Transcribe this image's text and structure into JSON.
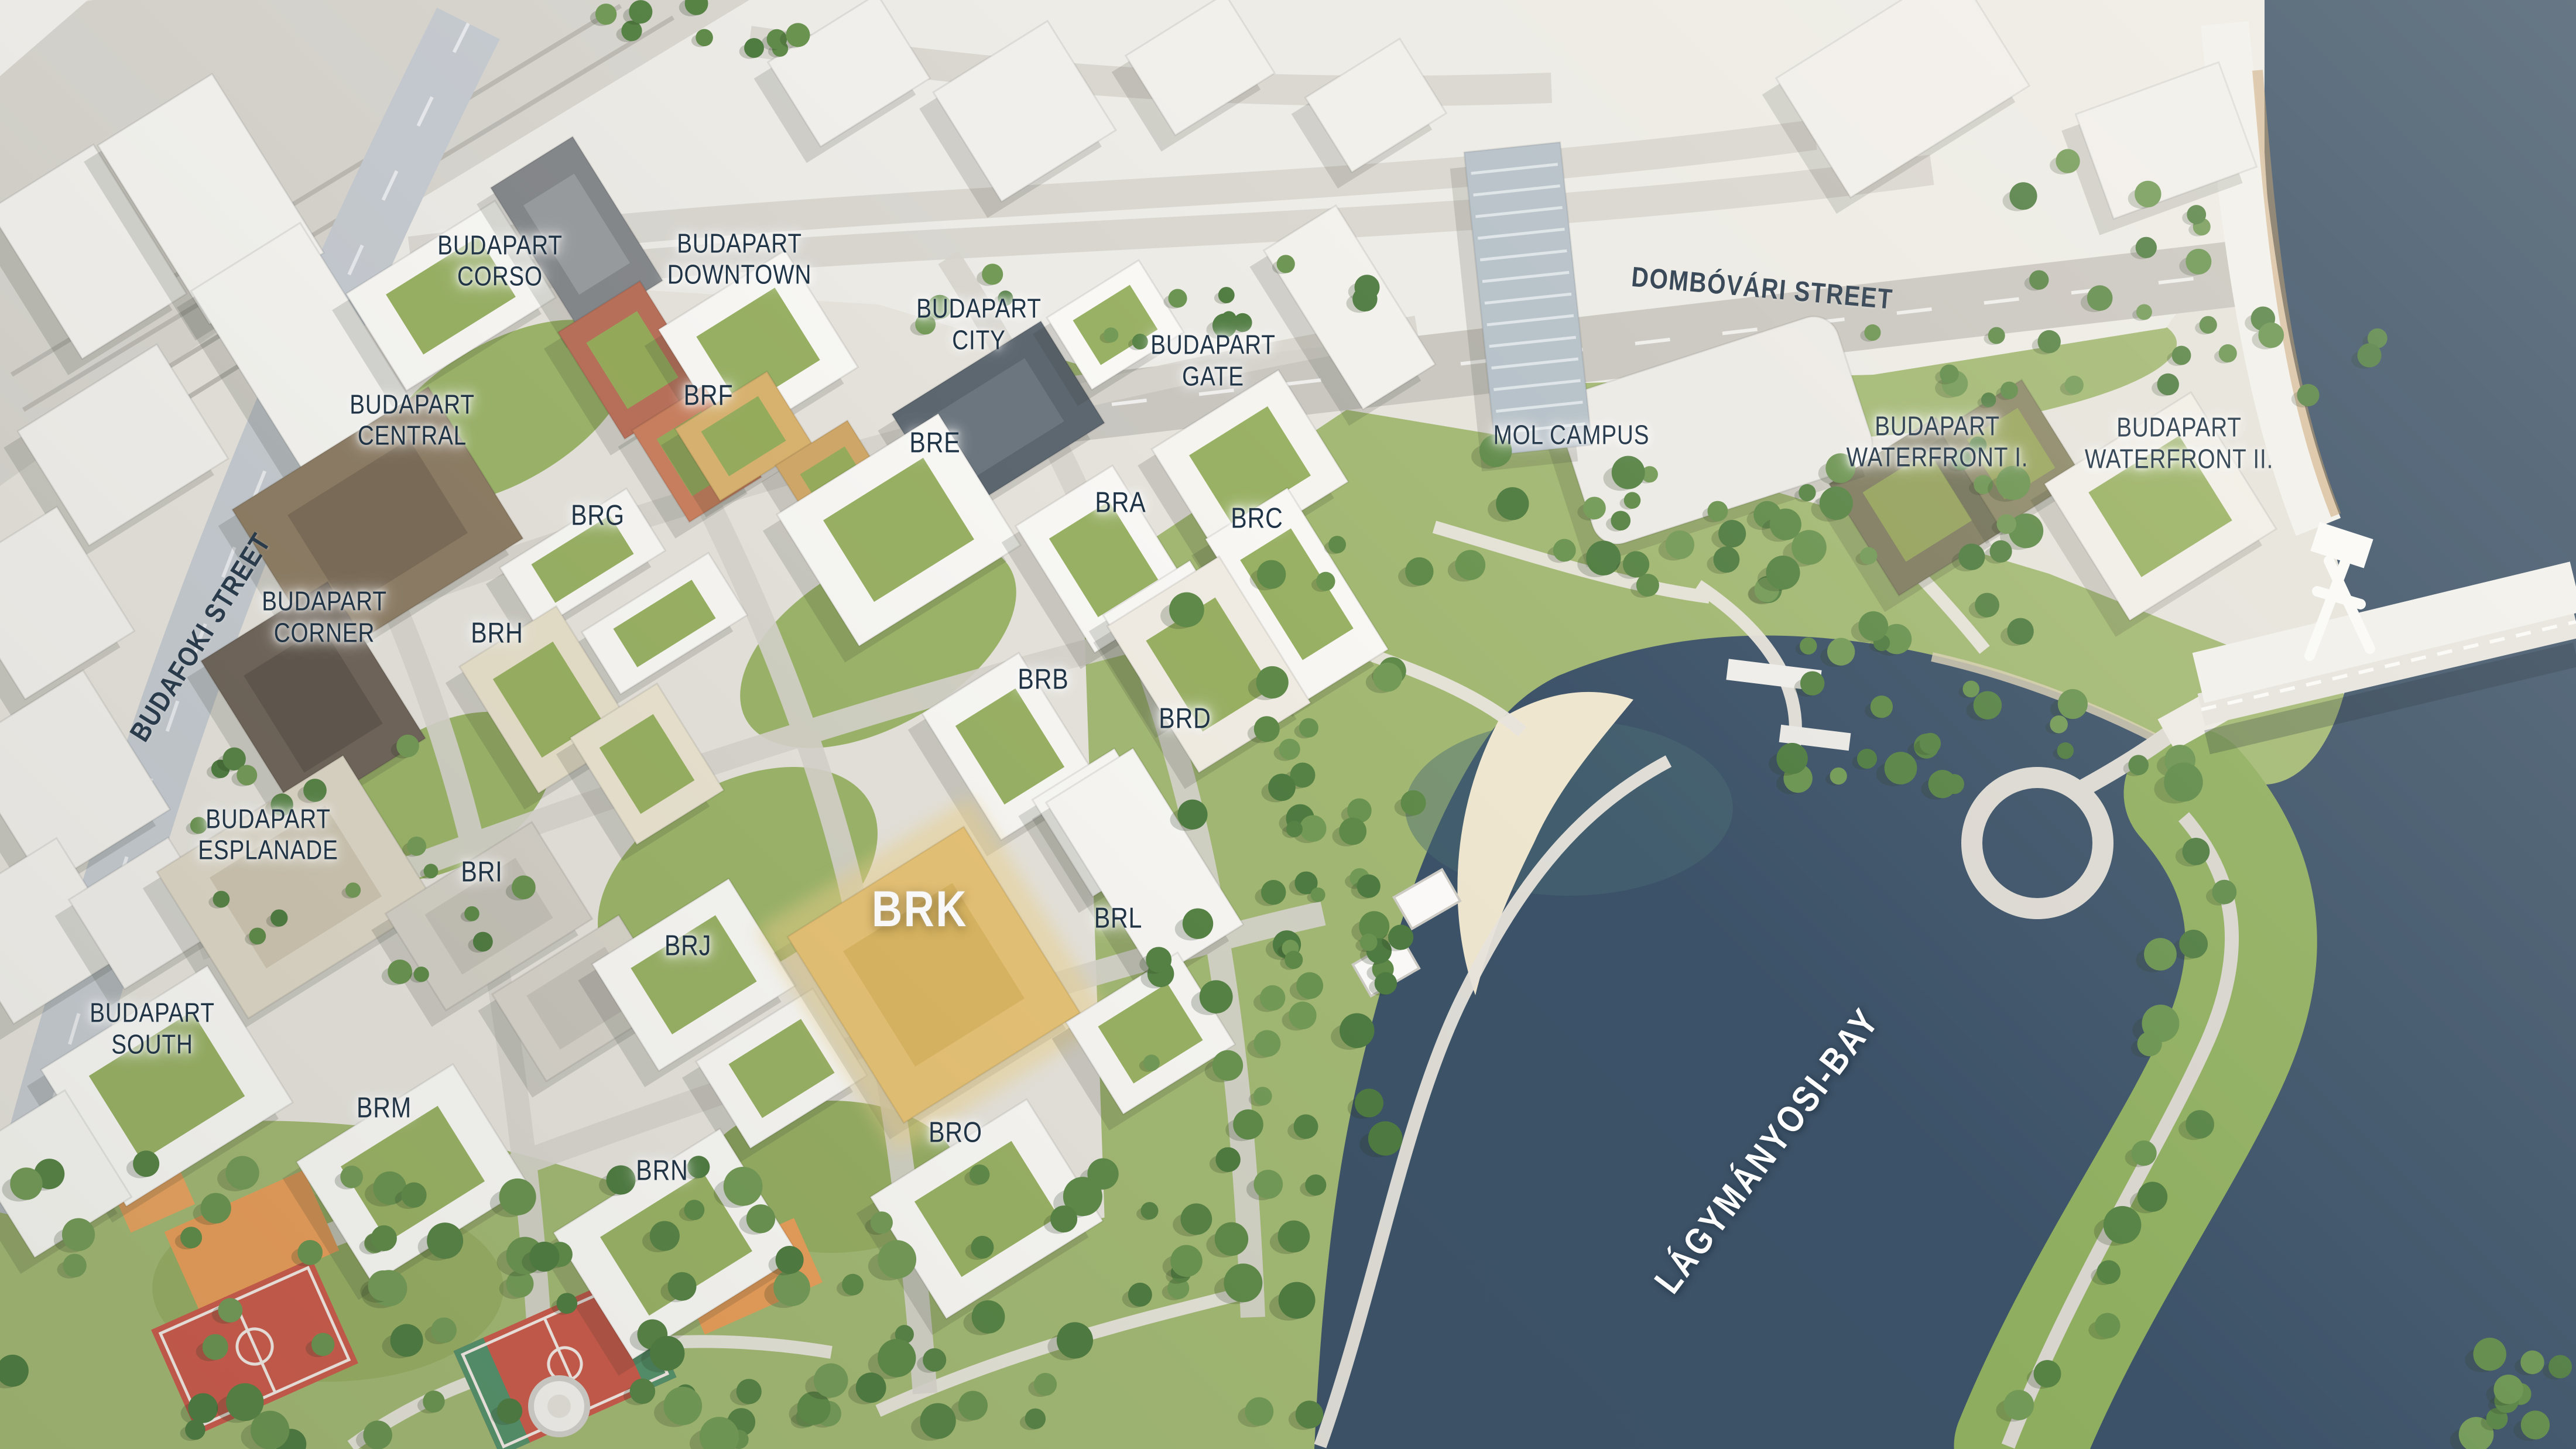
{
  "map": {
    "name": "BudaPart masterplan aerial map",
    "highlighted_building": "BRK",
    "colors": {
      "water": "#3C5268",
      "land": "#E6E3DC",
      "park": "#9FB66E",
      "green_roof": "#94AD5C",
      "highlight": "#E6C275",
      "label_dark": "#203447",
      "label_light": "#FFFFFF",
      "court_red": "#CB5A4B",
      "playground_orange": "#E89D59"
    },
    "labels": [
      {
        "id": "budapart-corso",
        "type": "district",
        "lines": [
          "BUDAPART",
          "CORSO"
        ],
        "x": 19.4,
        "y": 18.0,
        "rot": 0
      },
      {
        "id": "budapart-downtown",
        "type": "district",
        "lines": [
          "BUDAPART",
          "DOWNTOWN"
        ],
        "x": 28.7,
        "y": 17.9,
        "rot": 0
      },
      {
        "id": "budapart-city",
        "type": "district",
        "lines": [
          "BUDAPART",
          "CITY"
        ],
        "x": 38.0,
        "y": 22.4,
        "rot": 0
      },
      {
        "id": "budapart-gate",
        "type": "district",
        "lines": [
          "BUDAPART",
          "GATE"
        ],
        "x": 47.1,
        "y": 24.9,
        "rot": 0
      },
      {
        "id": "budapart-central",
        "type": "district",
        "lines": [
          "BUDAPART",
          "CENTRAL"
        ],
        "x": 16.0,
        "y": 29.0,
        "rot": 0
      },
      {
        "id": "budapart-corner",
        "type": "district",
        "lines": [
          "BUDAPART",
          "CORNER"
        ],
        "x": 12.6,
        "y": 42.6,
        "rot": 0
      },
      {
        "id": "budapart-esplanade",
        "type": "district",
        "lines": [
          "BUDAPART",
          "ESPLANADE"
        ],
        "x": 10.4,
        "y": 57.6,
        "rot": 0
      },
      {
        "id": "budapart-south",
        "type": "district",
        "lines": [
          "BUDAPART",
          "SOUTH"
        ],
        "x": 5.9,
        "y": 71.0,
        "rot": 0
      },
      {
        "id": "mol-campus",
        "type": "landmark",
        "lines": [
          "MOL CAMPUS"
        ],
        "x": 61.0,
        "y": 30.0,
        "rot": 0
      },
      {
        "id": "budapart-waterfront-i",
        "type": "district",
        "lines": [
          "BUDAPART",
          "WATERFRONT I."
        ],
        "x": 75.2,
        "y": 30.5,
        "rot": 0
      },
      {
        "id": "budapart-waterfront-ii",
        "type": "district",
        "lines": [
          "BUDAPART",
          "WATERFRONT II."
        ],
        "x": 84.6,
        "y": 30.6,
        "rot": 0
      },
      {
        "id": "brf",
        "type": "code",
        "lines": [
          "BRF"
        ],
        "x": 27.5,
        "y": 27.3,
        "rot": 0
      },
      {
        "id": "bre",
        "type": "code",
        "lines": [
          "BRE"
        ],
        "x": 36.3,
        "y": 30.6,
        "rot": 0
      },
      {
        "id": "brg",
        "type": "code",
        "lines": [
          "BRG"
        ],
        "x": 23.2,
        "y": 35.6,
        "rot": 0
      },
      {
        "id": "bra",
        "type": "code",
        "lines": [
          "BRA"
        ],
        "x": 43.5,
        "y": 34.7,
        "rot": 0
      },
      {
        "id": "brc",
        "type": "code",
        "lines": [
          "BRC"
        ],
        "x": 48.8,
        "y": 35.8,
        "rot": 0
      },
      {
        "id": "brh",
        "type": "code",
        "lines": [
          "BRH"
        ],
        "x": 19.3,
        "y": 43.7,
        "rot": 0
      },
      {
        "id": "brb",
        "type": "code",
        "lines": [
          "BRB"
        ],
        "x": 40.5,
        "y": 46.9,
        "rot": 0
      },
      {
        "id": "brd",
        "type": "code",
        "lines": [
          "BRD"
        ],
        "x": 46.0,
        "y": 49.6,
        "rot": 0
      },
      {
        "id": "bri",
        "type": "code",
        "lines": [
          "BRI"
        ],
        "x": 18.7,
        "y": 60.2,
        "rot": 0
      },
      {
        "id": "brj",
        "type": "code",
        "lines": [
          "BRJ"
        ],
        "x": 26.7,
        "y": 65.3,
        "rot": 0
      },
      {
        "id": "brk",
        "type": "highlight",
        "lines": [
          "BRK"
        ],
        "x": 35.7,
        "y": 62.8,
        "rot": 0
      },
      {
        "id": "brl",
        "type": "code",
        "lines": [
          "BRL"
        ],
        "x": 43.4,
        "y": 63.4,
        "rot": 0
      },
      {
        "id": "brm",
        "type": "code",
        "lines": [
          "BRM"
        ],
        "x": 14.9,
        "y": 76.5,
        "rot": 0
      },
      {
        "id": "brn",
        "type": "code",
        "lines": [
          "BRN"
        ],
        "x": 25.7,
        "y": 80.8,
        "rot": 0
      },
      {
        "id": "bro",
        "type": "code",
        "lines": [
          "BRO"
        ],
        "x": 37.1,
        "y": 78.2,
        "rot": 0
      },
      {
        "id": "dombovari-street",
        "type": "street",
        "lines": [
          "DOMBÓVÁRI STREET"
        ],
        "x": 68.4,
        "y": 19.9,
        "rot": 5
      },
      {
        "id": "budafoki-street",
        "type": "street",
        "lines": [
          "BUDAFOKI STREET"
        ],
        "x": 7.8,
        "y": 44.0,
        "rot": -58
      },
      {
        "id": "lagymanyosi-bay",
        "type": "water",
        "lines": [
          "LÁGYMÁNYOSI-BAY"
        ],
        "x": 68.6,
        "y": 79.4,
        "rot": -53
      }
    ]
  }
}
